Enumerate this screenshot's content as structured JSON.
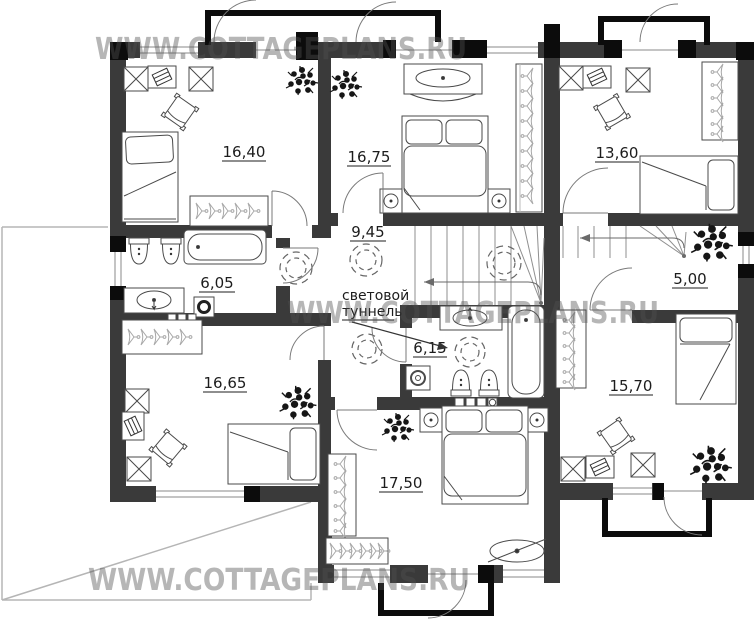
{
  "watermark": {
    "text": "WWW.COTTAGEPLANS.RU"
  },
  "rooms": [
    {
      "name": "bedroom-top-left",
      "area": "16,40"
    },
    {
      "name": "bedroom-top-middle",
      "area": "16,75"
    },
    {
      "name": "bedroom-top-right",
      "area": "13,60"
    },
    {
      "name": "bathroom-left",
      "area": "6,05"
    },
    {
      "name": "hall-center",
      "area": "9,45"
    },
    {
      "name": "corridor-right",
      "area": "5,00"
    },
    {
      "name": "bedroom-bottom-left",
      "area": "16,65"
    },
    {
      "name": "bathroom-middle",
      "area": "6,15"
    },
    {
      "name": "bedroom-bottom-right",
      "area": "15,70"
    },
    {
      "name": "bedroom-bottom-middle",
      "area": "17,50"
    }
  ],
  "annotations": {
    "light_tunnel_line1": "световой",
    "light_tunnel_line2": "туннель"
  },
  "colors": {
    "wall": "#3a3a3a",
    "accent_black": "#0c0c0c",
    "furniture_stroke": "#4a4a4a",
    "label": "#1c1c1c"
  }
}
